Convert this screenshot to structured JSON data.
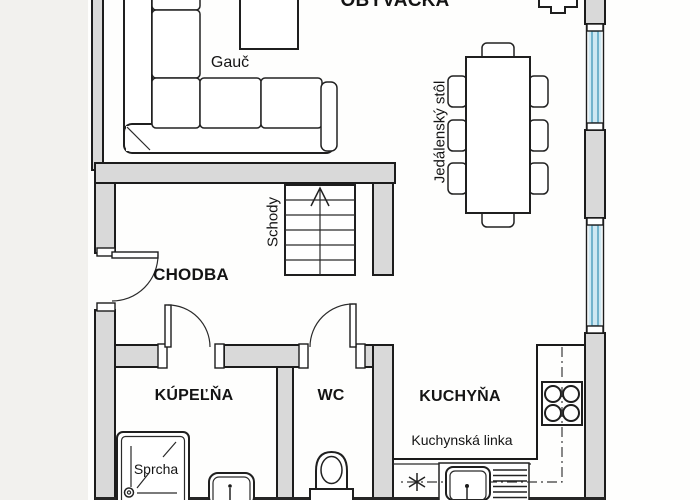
{
  "plan": {
    "type": "apartment floor plan",
    "language": "Slovak",
    "rooms": {
      "living_room": {
        "label": "OBÝVAČKA"
      },
      "hallway": {
        "label": "CHODBA"
      },
      "bathroom": {
        "label": "KÚPEĽŇA"
      },
      "wc": {
        "label": "WC"
      },
      "kitchen": {
        "label": "KUCHYŇA"
      }
    },
    "fixtures": {
      "sofa": {
        "label": "Gauč"
      },
      "dining_table": {
        "label": "Jedálenský stôl",
        "chair_count": 8
      },
      "stairs": {
        "label": "Schody",
        "direction": "up"
      },
      "kitchen_counter": {
        "label": "Kuchynská linka"
      },
      "shower": {
        "label": "Sprcha"
      },
      "stove": {
        "burner_count": 4
      },
      "windows": {
        "count": 2
      },
      "doors": {
        "count": 3
      }
    }
  },
  "colors": {
    "wall_fill": "#d9d9d9",
    "outline": "#1c1c1c",
    "glass": "#cfe8f2",
    "pane": "#5ca6c2",
    "floor": "#fefefd",
    "page": "#f2f1ee",
    "text": "#141414"
  }
}
